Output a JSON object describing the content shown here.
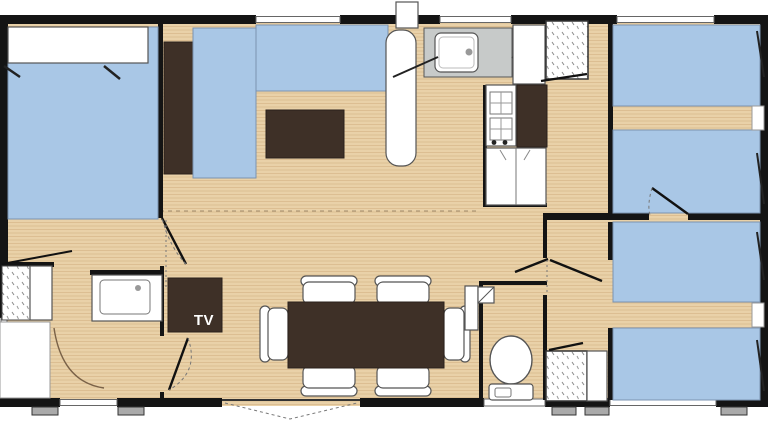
{
  "plan": {
    "labels": {
      "tv": "TV"
    },
    "colors": {
      "wall": "#141414",
      "wood_base": "#e9d1a8",
      "wood_streak": "#c8a06c",
      "bed_blue": "#a9c7e6",
      "blue_edge": "#7b93b0",
      "furniture_dark": "#3e3027",
      "counter_gray": "#c7cac9",
      "fixture_white": "#ffffff",
      "outline_gray": "#555555"
    }
  }
}
